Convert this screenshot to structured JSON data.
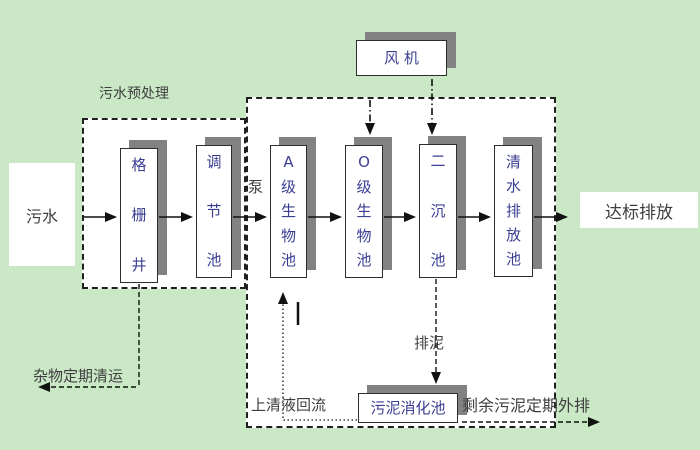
{
  "nodes": {
    "sewage": "污水",
    "grid_well": "格栅井",
    "regulating_tank": "调节池",
    "a_bio_tank": "A级生物池",
    "o_bio_tank": "O级生物池",
    "secondary_settling_tank": "二沉池",
    "clear_water_tank": "清水排放池",
    "blower": "风 机",
    "sludge_digestion_tank": "污泥消化池",
    "standard_discharge": "达标排放"
  },
  "labels": {
    "pretreatment": "污水预处理",
    "pump": "泵",
    "supernatant_return": "上清液回流",
    "sludge_discharge": "排泥",
    "excess_sludge": "剩余污泥定期外排",
    "debris_removal": "杂物定期清运"
  },
  "colors": {
    "background": "#cae8c6",
    "region_fill": "#ffffff",
    "box_shadow": "#828282",
    "box_border": "#2d2d2d",
    "dashed_border": "#1f1f1f",
    "box_text": "#3b3f93",
    "label_text": "#3f3f3f",
    "line": "#111111"
  }
}
